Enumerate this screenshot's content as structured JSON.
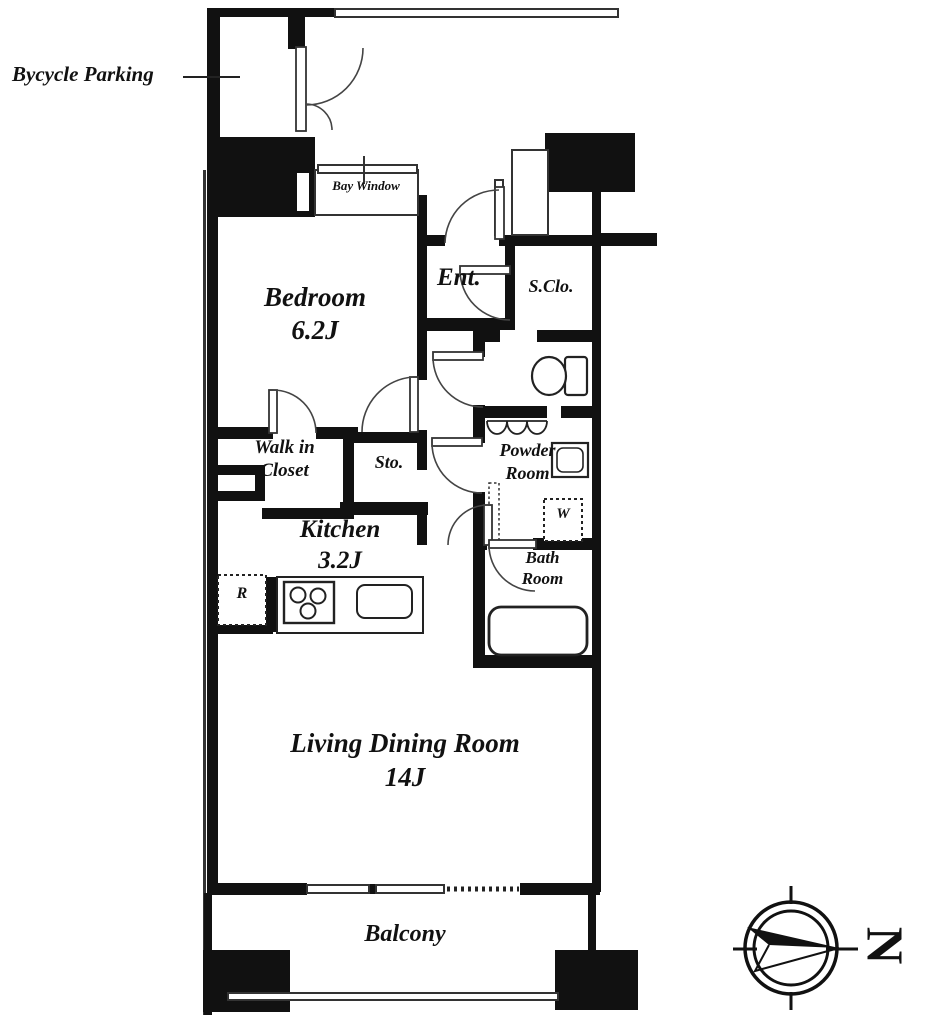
{
  "labels": {
    "bycycle_parking": "Bycycle Parking",
    "bay_window": "Bay Window",
    "bedroom_name": "Bedroom",
    "bedroom_size": "6.2J",
    "entrance": "Ent.",
    "shoe_closet": "S.Clo.",
    "walk_in_closet_1": "Walk in",
    "walk_in_closet_2": "Closet",
    "storage": "Sto.",
    "powder_room_1": "Powder",
    "powder_room_2": "Room",
    "washer": "W",
    "bath_room_1": "Bath",
    "bath_room_2": "Room",
    "kitchen_name": "Kitchen",
    "kitchen_size": "3.2J",
    "living_dining_name": "Living Dining Room",
    "living_dining_size": "14J",
    "balcony": "Balcony",
    "refrigerator": "R"
  },
  "compass": {
    "letter": "N",
    "points": "right"
  },
  "colors": {
    "wall": "#111111",
    "line": "#333333",
    "background": "#ffffff"
  }
}
